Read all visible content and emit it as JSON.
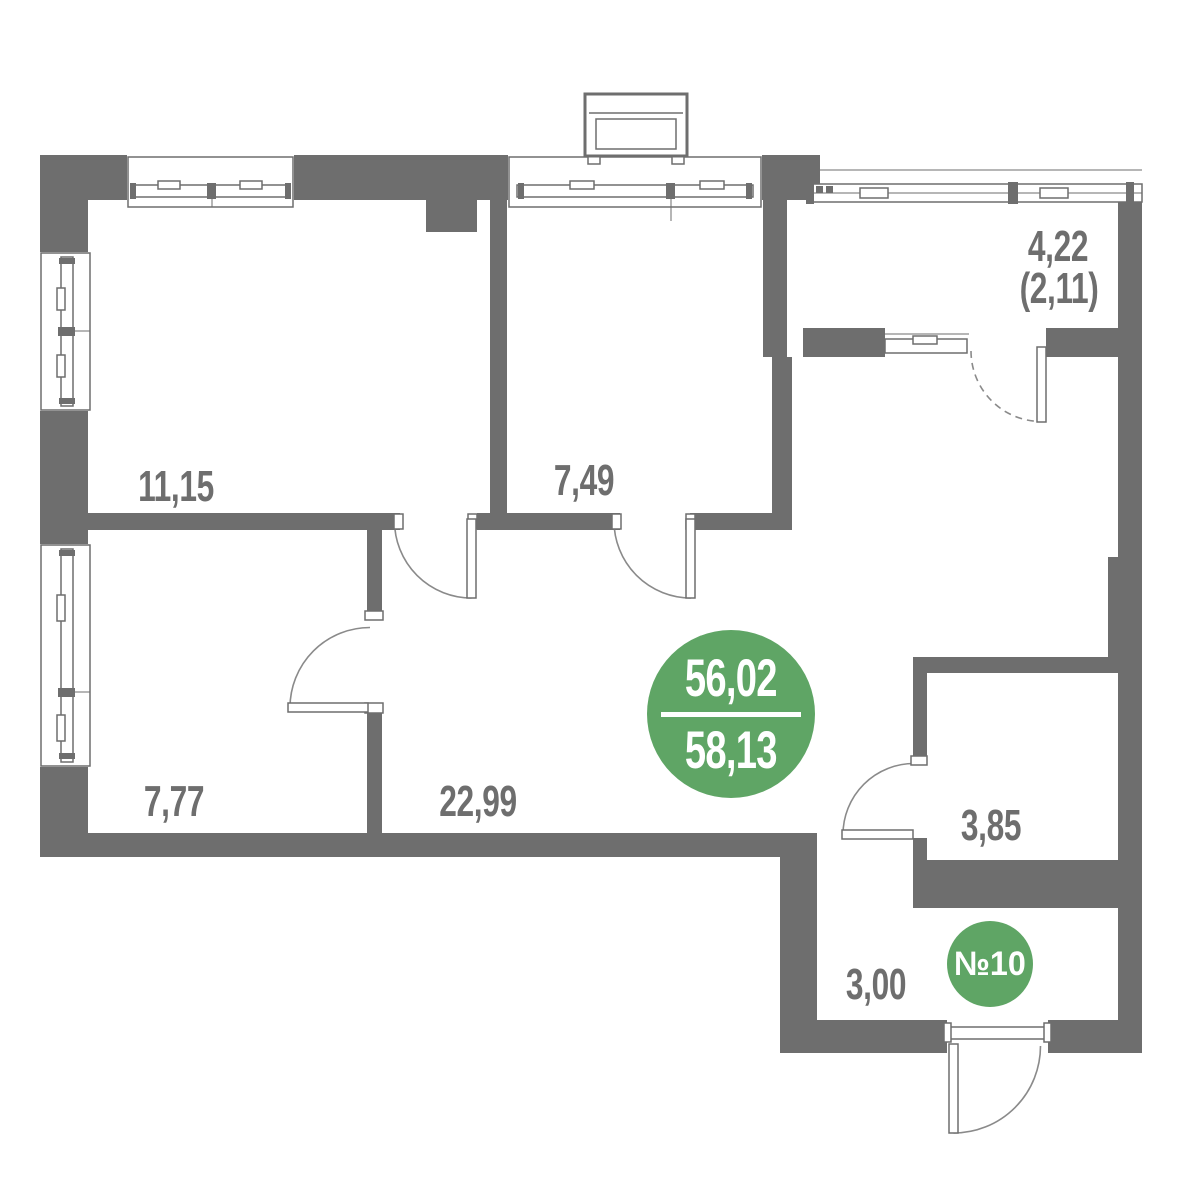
{
  "plan_title": "apartment-floor-plan",
  "colors": {
    "wall": "#6e6e6e",
    "accent": "#5fa565",
    "label": "#6e6e6e"
  },
  "area_badge": {
    "total": "56,02",
    "living": "58,13"
  },
  "unit_badge": {
    "label": "№10"
  },
  "rooms": [
    {
      "id": "bedroom",
      "area": "11,15"
    },
    {
      "id": "kitchen",
      "area": "7,49"
    },
    {
      "id": "room",
      "area": "7,77"
    },
    {
      "id": "living",
      "area": "22,99"
    },
    {
      "id": "bathroom",
      "area": "3,85"
    },
    {
      "id": "hallway",
      "area": "3,00"
    }
  ],
  "balcony": {
    "area": "4,22",
    "area_reduced": "(2,11)"
  }
}
